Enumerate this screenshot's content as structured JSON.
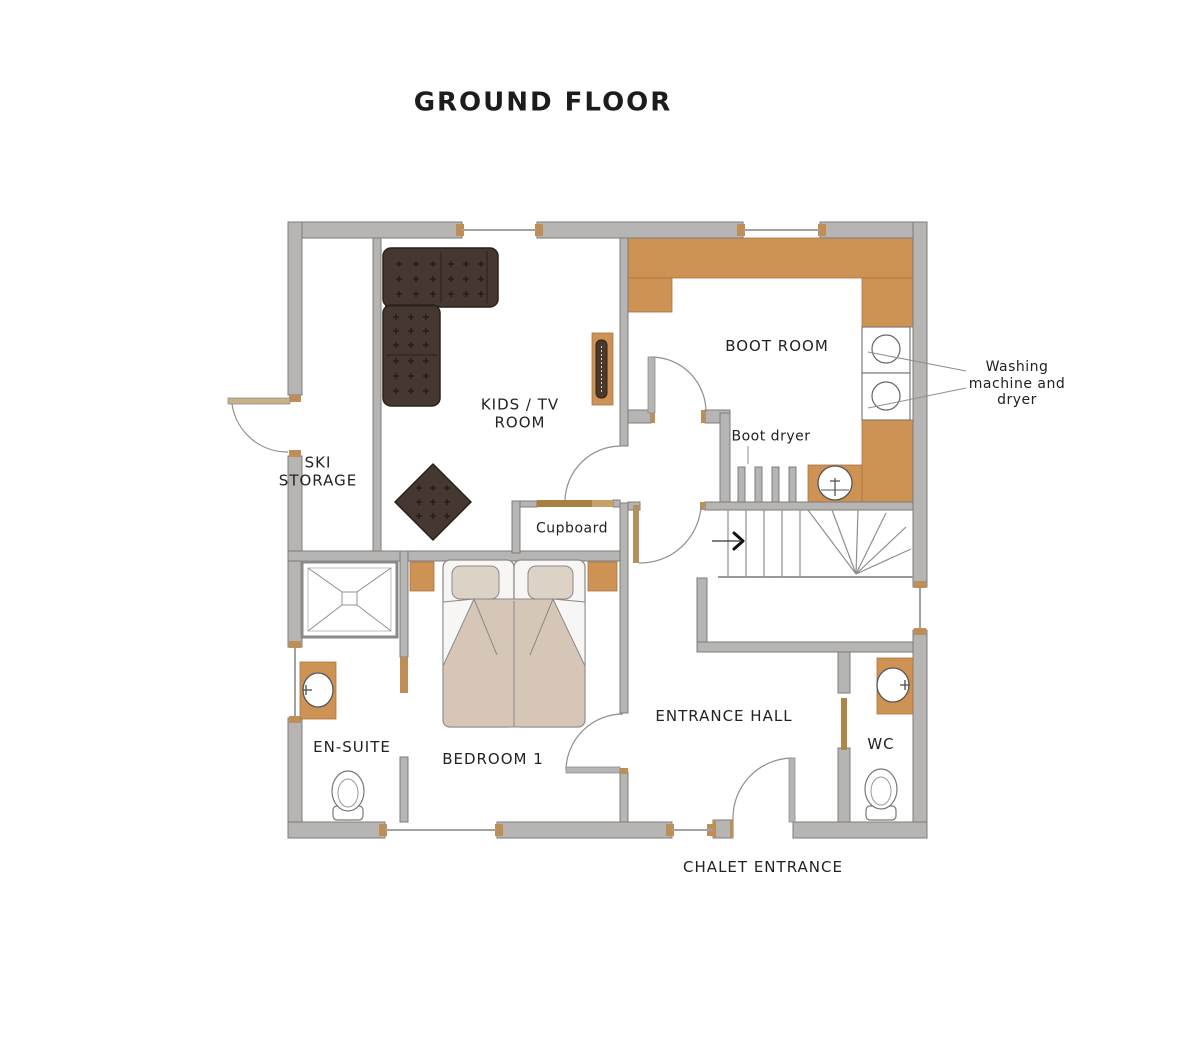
{
  "title": "GROUND FLOOR",
  "rooms": {
    "ski_storage": {
      "line1": "SKI",
      "line2": "STORAGE"
    },
    "kids_tv": {
      "line1": "KIDS / TV",
      "line2": "ROOM"
    },
    "boot_room": {
      "label": "BOOT ROOM"
    },
    "cupboard": {
      "label": "Cupboard"
    },
    "en_suite": {
      "label": "EN-SUITE"
    },
    "bedroom1": {
      "label": "BEDROOM 1"
    },
    "entrance_hall": {
      "label": "ENTRANCE HALL"
    },
    "wc": {
      "label": "WC"
    }
  },
  "annotations": {
    "washing": {
      "line1": "Washing",
      "line2": "machine and",
      "line3": "dryer"
    },
    "boot_dryer": {
      "label": "Boot dryer"
    },
    "chalet_entrance": {
      "label": "CHALET ENTRANCE"
    }
  },
  "icons": [
    "sofa-icon",
    "ottoman-icon",
    "tv-icon",
    "shower-icon",
    "sink-icon",
    "toilet-icon",
    "twin-beds-icon",
    "bedside-table-icon",
    "washing-machine-icon",
    "dryer-icon",
    "boot-dryer-rack-icon",
    "boot-room-sink-icon",
    "staircase-icon",
    "door-arc-icon",
    "window-icon"
  ],
  "colors": {
    "wall_gray": "#b6b5b3",
    "wall_outline": "#7d7c7a",
    "accent_orange": "#cd9254",
    "wood_tan": "#bf8e57",
    "door_brown": "#a97f42",
    "sofa_brown": "#463830",
    "duvet_beige": "#d6c6b8",
    "pillow_beige": "#ddd2c6",
    "text": "#222222"
  }
}
